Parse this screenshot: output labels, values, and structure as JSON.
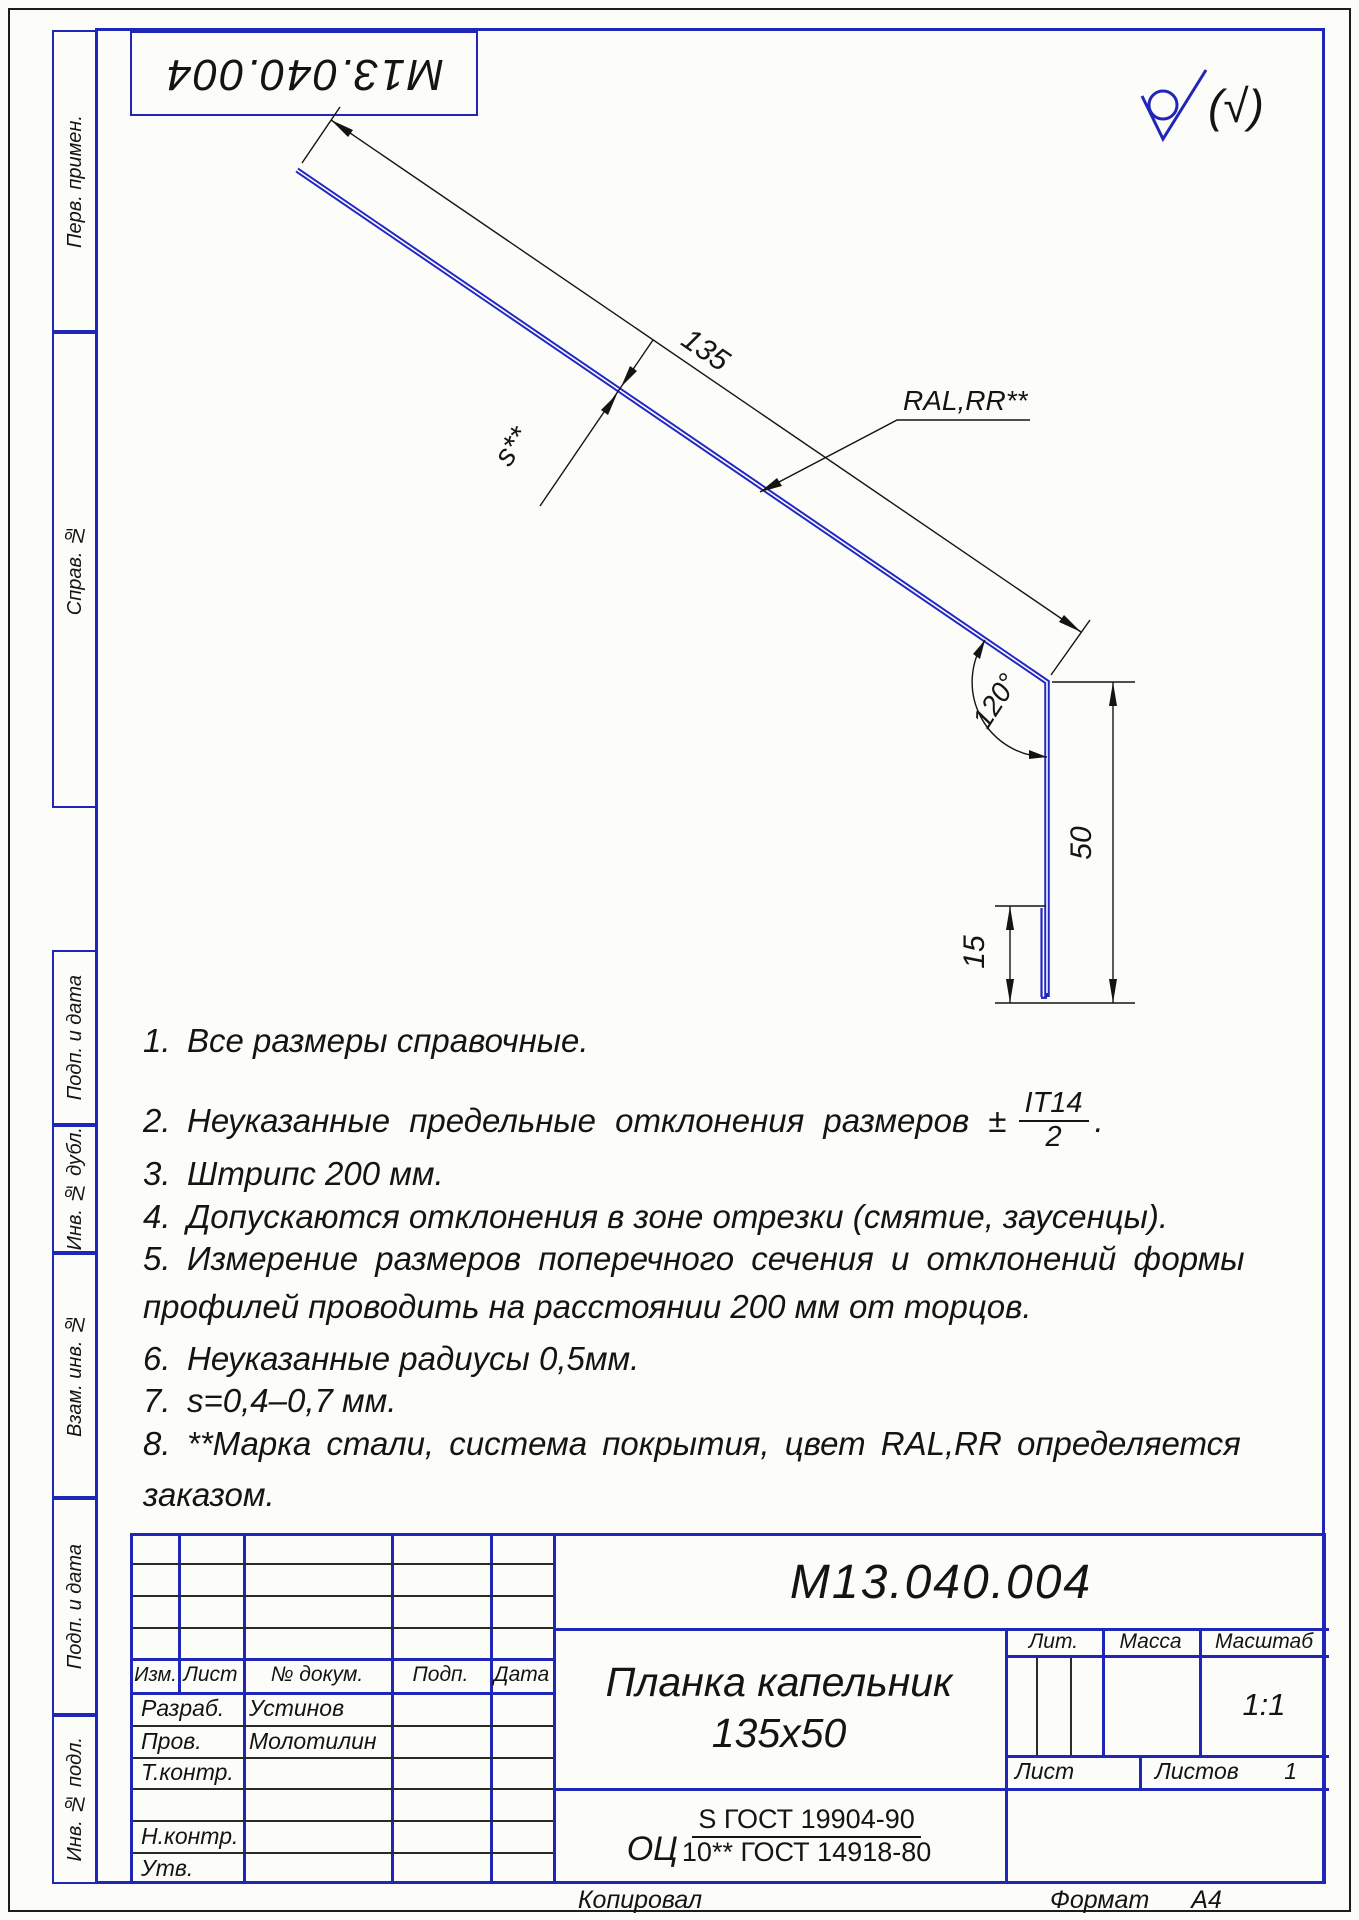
{
  "page": {
    "designation_stamp": "М13.040.004",
    "roughness_note": "(√)"
  },
  "sidebar": {
    "perv_primen": "Перв. примен.",
    "sprav_no": "Справ. №",
    "podp_data_1": "Подп. и дата",
    "inv_dubl": "Инв. № дубл.",
    "vzam_inv": "Взам. инв. №",
    "podp_data_2": "Подп. и дата",
    "inv_podl": "Инв. № подл."
  },
  "drawing": {
    "dim_length": "135",
    "dim_thickness": "s**",
    "coating_label": "RAL,RR**",
    "dim_angle": "120°",
    "dim_height": "50",
    "dim_hem": "15"
  },
  "notes": {
    "n1_num": "1.",
    "n1": "Все размеры справочные.",
    "n2_num": "2.",
    "n2": "Неуказанные предельные отклонения размеров ±",
    "n2_frac_num": "IT14",
    "n2_frac_den": "2",
    "n2_tail": ".",
    "n3_num": "3.",
    "n3": "Штрипс 200 мм.",
    "n4_num": "4.",
    "n4": "Допускаются отклонения в зоне отрезки (смятие, заусенцы).",
    "n5_num": "5.",
    "n5a": "Измерение размеров поперечного сечения и отклонений формы",
    "n5b": "профилей проводить на расстоянии 200 мм от торцов.",
    "n6_num": "6.",
    "n6": "Неуказанные радиусы 0,5мм.",
    "n7_num": "7.",
    "n7": "s=0,4–0,7 мм.",
    "n8_num": "8.",
    "n8a": "**Марка стали, система покрытия, цвет RAL,RR определяется",
    "n8b": "заказом."
  },
  "title_block": {
    "designation": "М13.040.004",
    "name_line1": "Планка капельник",
    "name_line2": "135х50",
    "material_prefix": "ОЦ",
    "material_top": "S ГОСТ 19904-90",
    "material_bottom": "10** ГОСТ 14918-80",
    "col_izm": "Изм.",
    "col_list": "Лист",
    "col_dokum": "№ докум.",
    "col_podp": "Подп.",
    "col_data": "Дата",
    "row_razrab": "Разраб.",
    "razrab_name": "Устинов",
    "row_prov": "Пров.",
    "prov_name": "Молотилин",
    "row_tkontr": "Т.контр.",
    "row_nkontr": "Н.контр.",
    "row_utv": "Утв.",
    "lit_label": "Лит.",
    "massa_label": "Масса",
    "masshtab_label": "Масштаб",
    "scale": "1:1",
    "list_label": "Лист",
    "listov_label": "Листов",
    "listov_value": "1"
  },
  "footer": {
    "kopiroval": "Копировал",
    "format_label": "Формат",
    "format_value": "А4"
  }
}
